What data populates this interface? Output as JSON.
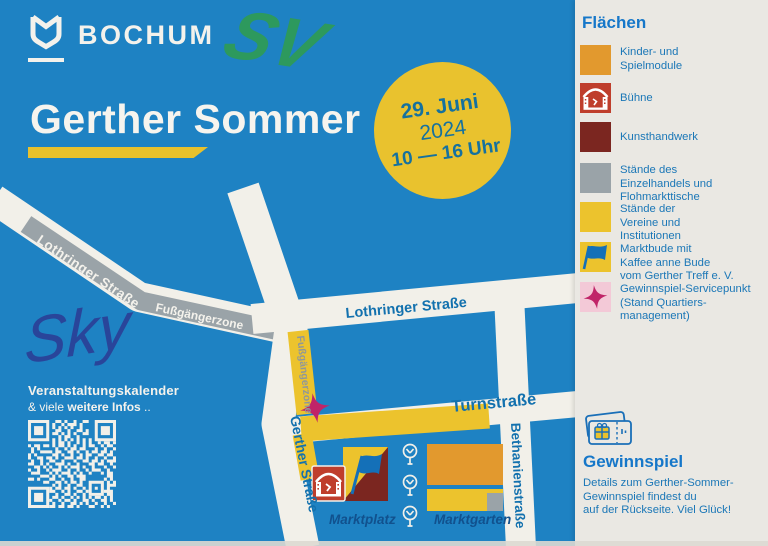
{
  "brand": {
    "name": "BOCHUM"
  },
  "title": "Gerther Sommer",
  "date_badge": {
    "line1": "29. Juni",
    "line2": "2024",
    "line3": "10 — 16 Uhr"
  },
  "annotations": {
    "marker": "SV",
    "signature": "Sky"
  },
  "map": {
    "labels": {
      "lothringer_diagonal": "Lothringer Straße",
      "pedestrian_zone_upper": "Fußgängerzone",
      "lothringer_horizontal": "Lothringer Straße",
      "pedestrian_zone_vertical": "Fußgängerzone",
      "turnstrasse": "Turnstraße",
      "gerther_strasse": "Gerther Straße",
      "bethanienstrasse": "Bethanienstraße",
      "marktplatz": "Marktplatz",
      "marktgarten": "Marktgarten"
    }
  },
  "footer": {
    "line1": "Veranstaltungskalender",
    "line2_prefix": "& viele ",
    "line2_bold": "weitere Infos",
    "line2_suffix": " .."
  },
  "legend": {
    "heading": "Flächen",
    "items": [
      {
        "id": "kinder",
        "label": "Kinder- und\nSpielmodule"
      },
      {
        "id": "buehne",
        "label": "Bühne"
      },
      {
        "id": "kunsthandwerk",
        "label": "Kunsthandwerk"
      },
      {
        "id": "einzelhandel",
        "label": "Stände des\nEinzelhandels und\nFlohmarkttische"
      },
      {
        "id": "vereine",
        "label": "Stände der\nVereine und\nInstitutionen"
      },
      {
        "id": "marktbude",
        "label": "Marktbude mit\nKaffee anne Bude\nvom Gerther Treff e. V."
      },
      {
        "id": "gewinnspiel_punkt",
        "label": "Gewinnspiel-Servicepunkt\n(Stand Quartiers-\nmanagement)"
      }
    ]
  },
  "gewinnspiel": {
    "heading": "Gewinnspiel",
    "body": "Details zum Gerther-Sommer-\nGewinnspiel findest du\nauf der Rückseite. Viel Glück!"
  },
  "colors": {
    "background_blue": "#1e82c3",
    "sidebar_bg": "#eae8e3",
    "road_white": "#f2f0e9",
    "road_gray": "#9aa3a8",
    "yellow": "#ecc32d",
    "orange": "#e2992e",
    "dark_red": "#7b2620",
    "stage_red": "#bf3e2c",
    "magenta": "#c02468",
    "pink_swatch": "#f3c9d7",
    "flag_blue": "#1470b8",
    "text_blue": "#1371ae",
    "heading_blue": "#1677c9",
    "marker_green": "#2f9b55",
    "pen_blue": "#2b3f96"
  }
}
